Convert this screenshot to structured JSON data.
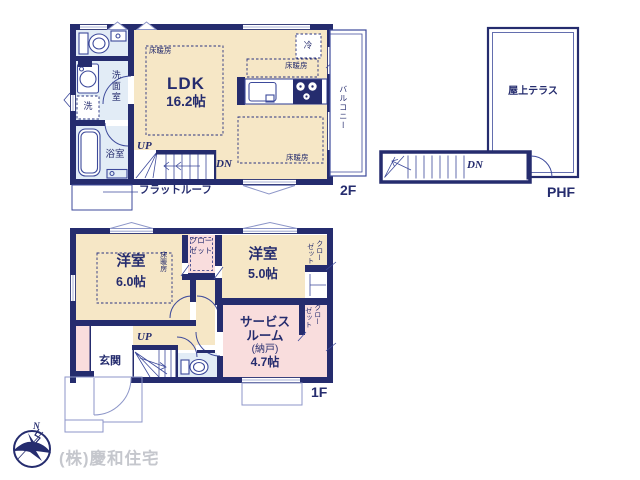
{
  "colors": {
    "wall": "#252c6e",
    "line": "#3d4a9b",
    "lightline": "#8d96c8",
    "cream": "#f6e7c6",
    "pink": "#f9dddd",
    "blue": "#e2ecf6",
    "dash": "#2a3380",
    "graytext": "#c5c7cd"
  },
  "f2": {
    "label": "2F",
    "ldk": {
      "name": "LDK",
      "size": "16.2帖"
    },
    "washroom": "洗面室",
    "bathroom": "浴室",
    "laundry": "洗",
    "fridge": "冷",
    "heating": "床暖房",
    "balcony": "バルコニー",
    "flat_roof": "フラットルーフ",
    "up": "UP",
    "dn": "DN"
  },
  "phf": {
    "label": "PHF",
    "terrace": "屋上テラス",
    "dn": "DN"
  },
  "f1": {
    "label": "1F",
    "bedroom1": {
      "name": "洋室",
      "size": "6.0帖"
    },
    "bedroom2": {
      "name": "洋室",
      "size": "5.0帖"
    },
    "service_room": {
      "line1": "サービス",
      "line2": "ルーム",
      "line3": "(納戸)",
      "line4": "4.7帖"
    },
    "entrance": "玄関",
    "closet_line1": "クロー",
    "closet_line2": "ゼット",
    "heating": "床暖房",
    "up": "UP"
  },
  "footer": {
    "company": "(株)慶和住宅",
    "compass": "N"
  }
}
